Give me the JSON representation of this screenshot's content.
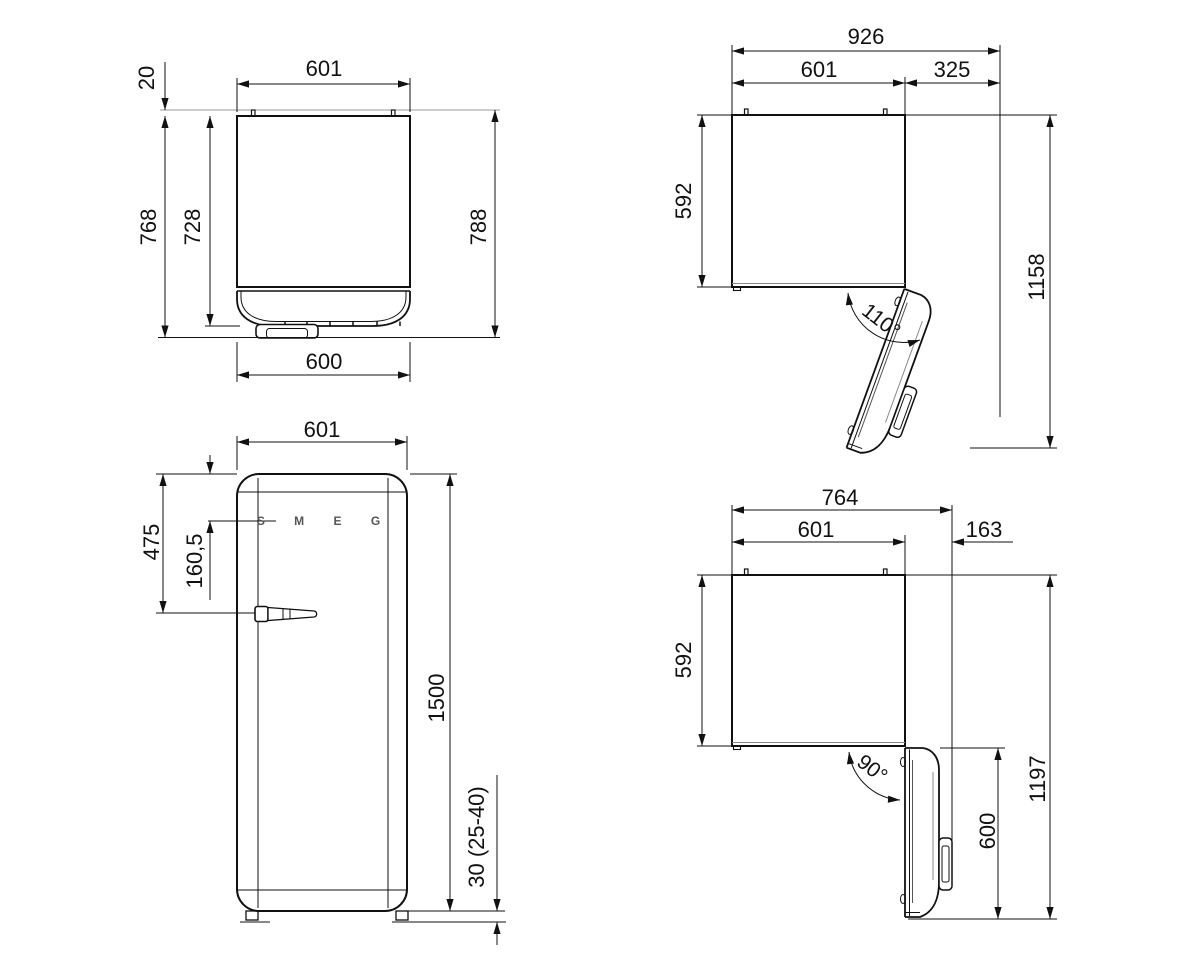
{
  "page": {
    "background": "#ffffff",
    "line_color": "#111111",
    "wall_line_color": "#999999"
  },
  "drawing": {
    "product": "refrigerator-installation-technical-drawing",
    "views": {
      "top_closed": {
        "name": "top-view-door-closed",
        "width_top": "601",
        "rear_clearance": "20",
        "depth_body": "728",
        "depth_with_door": "768",
        "depth_total": "788",
        "width_bottom": "600"
      },
      "top_open_110": {
        "name": "top-view-door-open-110",
        "overall_width": "926",
        "body_width": "601",
        "door_projection": "325",
        "body_depth": "592",
        "overall_depth": "1158",
        "opening_angle": "110°"
      },
      "front": {
        "name": "front-view",
        "width": "601",
        "top_to_handle": "475",
        "top_to_logo": "160,5",
        "height": "1500",
        "feet_height": "30 (25-40)",
        "logo": "S M E G"
      },
      "top_open_90": {
        "name": "top-view-door-open-90",
        "overall_width": "764",
        "body_width": "601",
        "door_projection": "163",
        "body_depth": "592",
        "overall_depth": "1197",
        "door_width": "600",
        "opening_angle": "90°"
      }
    }
  }
}
